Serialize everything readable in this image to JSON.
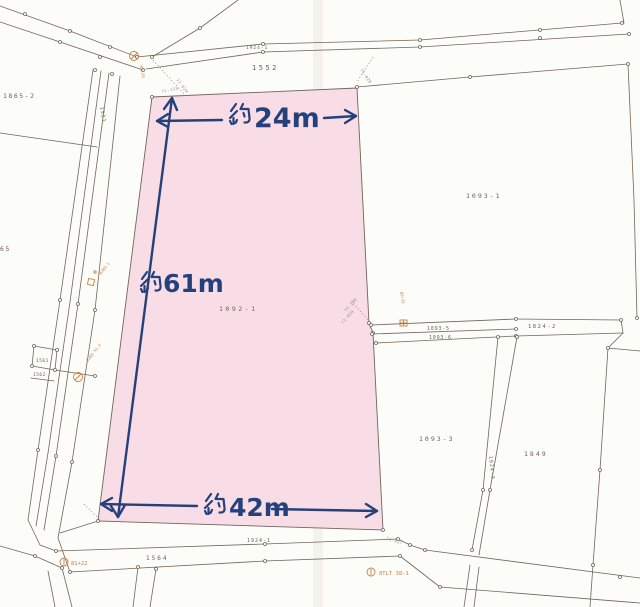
{
  "map": {
    "type": "cadastral-parcel-map",
    "colors": {
      "paper": "#fcfcf8",
      "line": "#6f665c",
      "subject_fill": "#f8dde7",
      "dimension_blue": "#25417c",
      "benchmark_orange": "#c9813e",
      "tiny_gray": "#938a80"
    },
    "subject_parcel": {
      "number": "1092-1"
    },
    "dimensions": {
      "top": {
        "label": "約24m",
        "display_value": "24m",
        "kanji_prefix": "約"
      },
      "left": {
        "label": "約61m",
        "display_value": "61m",
        "kanji_prefix": "約"
      },
      "bottom": {
        "label": "約42m",
        "display_value": "42m",
        "kanji_prefix": "約"
      }
    },
    "parcel_labels": {
      "p1865_2": "1865-2",
      "p65": "65",
      "p1552": "1552",
      "p1924_1_top": "1924-1",
      "p1093_1": "1093-1",
      "p1092_1": "1092-1",
      "p1093_5": "1093-5",
      "p1093_6": "1093-6",
      "p1824_2": "1824-2",
      "p1093_3": "1093-3",
      "p1849": "1849",
      "p1924_3": "1924-3",
      "p1924_1_bottom": "1924-1",
      "p1564": "1564",
      "p1561": "1561",
      "p1562": "1562",
      "p1521": "1521"
    },
    "survey_point_labels": {
      "s71_029_a": "71-029",
      "s71_119": "71-119",
      "s71_028": "71-028",
      "s72_108": "72-108",
      "s71_029_b": "71-029",
      "s71_027": "71-027"
    },
    "benchmark_labels": {
      "bm_top": "B1+29",
      "bm_mid_upper": "82B5-1",
      "bm_mid_lower": "8288 51-2",
      "bm_strip": "B5+15",
      "bm_bottom_left": "81+22",
      "bm_bottom_right": "8TLT 38-1"
    }
  }
}
